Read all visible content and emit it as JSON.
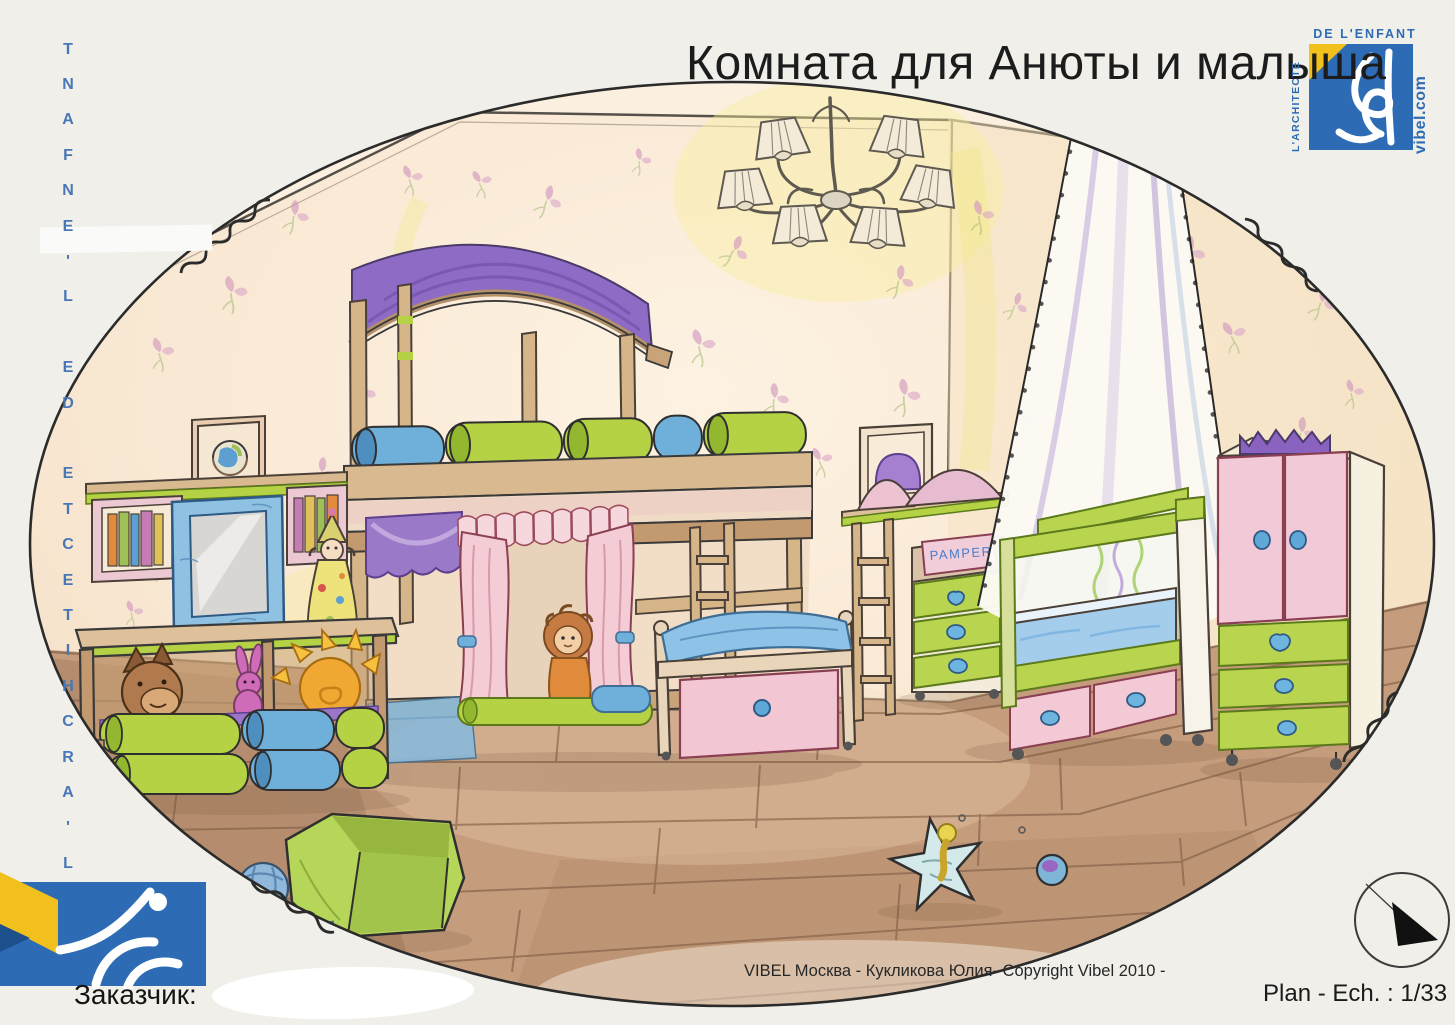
{
  "page": {
    "title": "Комната для Анюты и малыша"
  },
  "left_margin": {
    "vertical_text": "L'ARCHITECTE DE L'ENFANT"
  },
  "logo_top_right": {
    "top_text": "DE L'ENFANT",
    "side_text": "L'ARCHITECTE",
    "website": "vibel.com"
  },
  "footer": {
    "client_label": "Заказчик:",
    "credit": "VIBEL Москва -  Кукликова Юлия- Copyright Vibel  2010 -",
    "plan_scale": "Plan - Ech. : 1/33"
  },
  "drawing": {
    "pampers_box_text": "PAMPERS"
  },
  "colors": {
    "brand_blue": "#2d6cb4",
    "brand_yellow": "#f2c01d",
    "accent_green": "#b5d245",
    "accent_blue": "#6fb0da",
    "accent_pink": "#f2c9d5",
    "accent_purple": "#8f6cc5"
  }
}
